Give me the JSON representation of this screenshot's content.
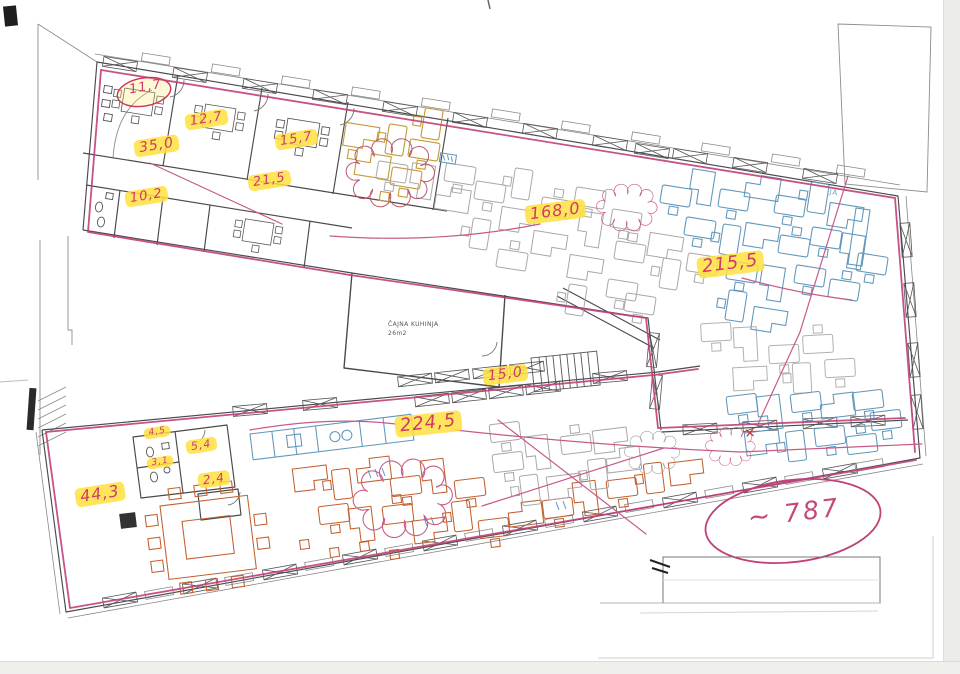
{
  "document": {
    "kind": "scanned architectural floor plan with handwritten area take-off markup",
    "language": "hr"
  },
  "rooms": {
    "kitchen": {
      "name": "ČAJNA KUHINJA",
      "area": "26m2"
    }
  },
  "area_labels": [
    {
      "name": "room-11-7",
      "value": "11,7",
      "highlighted": false,
      "circled": true
    },
    {
      "name": "room-12-7",
      "value": "12,7",
      "highlighted": true,
      "circled": false
    },
    {
      "name": "room-15-7",
      "value": "15,7",
      "highlighted": true,
      "circled": false
    },
    {
      "name": "corridor-35-0",
      "value": "35,0",
      "highlighted": true,
      "circled": false
    },
    {
      "name": "wc-10-2",
      "value": "10,2",
      "highlighted": true,
      "circled": false
    },
    {
      "name": "room-21-5",
      "value": "21,5",
      "highlighted": true,
      "circled": false
    },
    {
      "name": "open-office-168-0",
      "value": "168,0",
      "highlighted": true,
      "circled": false
    },
    {
      "name": "open-office-215-5",
      "value": "215,5",
      "highlighted": true,
      "circled": false
    },
    {
      "name": "stairs-15-0",
      "value": "15,0",
      "highlighted": true,
      "circled": false
    },
    {
      "name": "open-office-224-5",
      "value": "224,5",
      "highlighted": true,
      "circled": false
    },
    {
      "name": "zone-44-3",
      "value": "44,3",
      "highlighted": true,
      "circled": false
    },
    {
      "name": "wc-4-5",
      "value": "4,5",
      "highlighted": true,
      "circled": false
    },
    {
      "name": "room-5-4",
      "value": "5,4",
      "highlighted": true,
      "circled": false
    },
    {
      "name": "wc-3-1",
      "value": "3,1",
      "highlighted": true,
      "circled": false
    },
    {
      "name": "corridor-2-4",
      "value": "2,4",
      "highlighted": true,
      "circled": false
    }
  ],
  "annotations": {
    "total": {
      "symbol": "~",
      "value": "787"
    },
    "side_note": "JA",
    "x_mark": "✕"
  },
  "colors": {
    "marker_pink": "#c0407a",
    "handwriting_red": "#cf3a66",
    "highlight_yellow": "#ffe140",
    "furniture_blue": "#5f96bb",
    "furniture_orange": "#c2602f",
    "furniture_mustard": "#c49a3a",
    "pencil_gray": "#a8a8a8",
    "wall_dark": "#4a4a4a"
  }
}
